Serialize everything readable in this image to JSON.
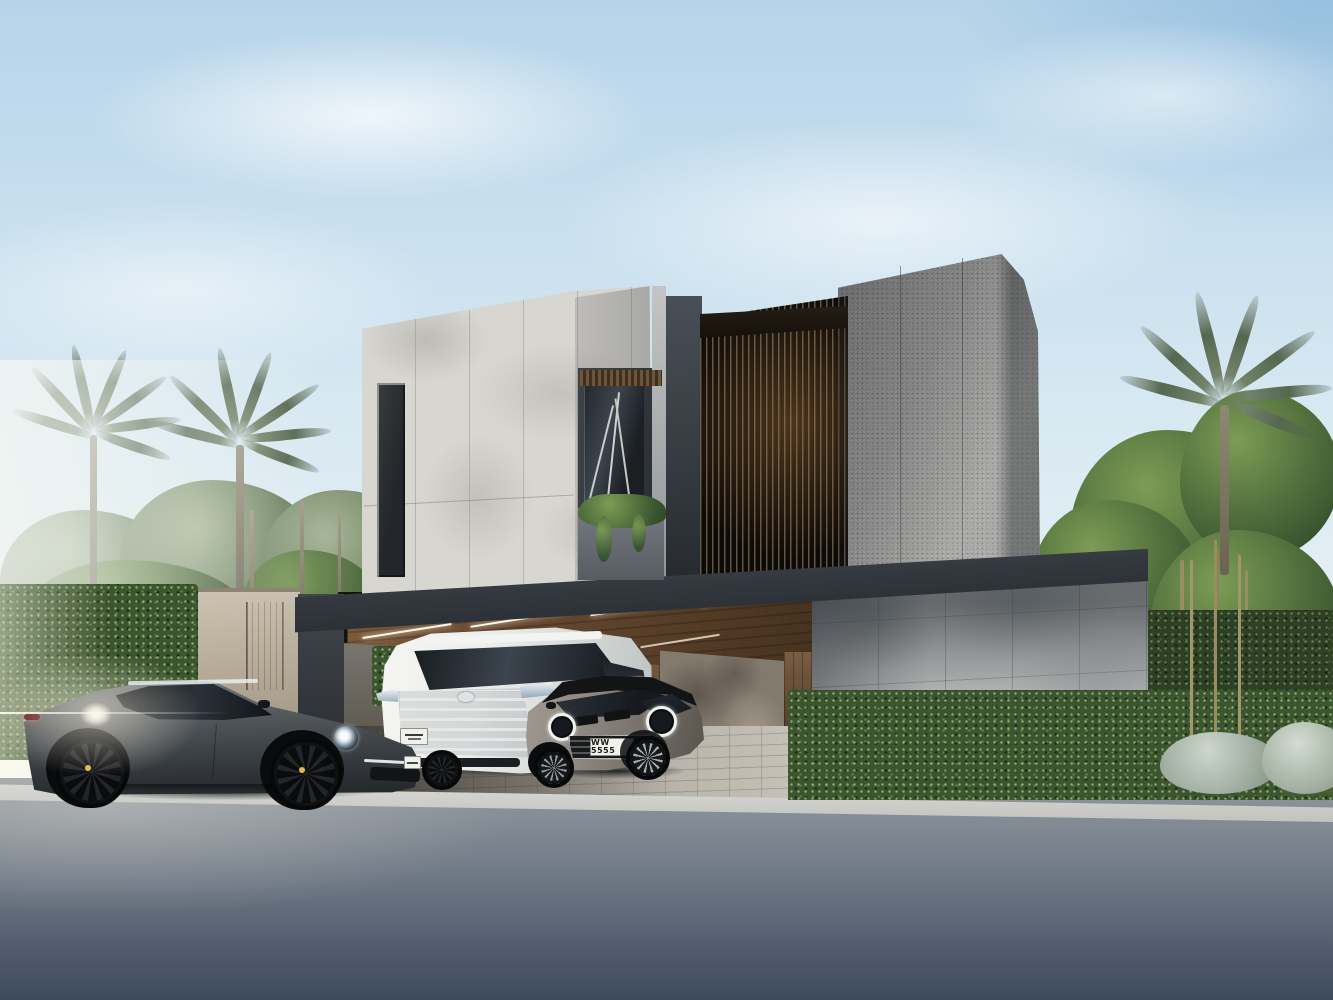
{
  "scene": {
    "type": "exterior architectural rendering",
    "description": "Modern two-storey luxury villa with travertine and granite volumes, vertical slat screen, covered carport with wood ceiling, tall hedges, palm trees, and three cars at dusk sunlight",
    "palette": {
      "sky_top": "#b6d4e9",
      "sky_horizon": "#f3f6f3",
      "travertine": "#d8d6d1",
      "granite": "#9c9c9a",
      "dark_wall": "#3c4147",
      "slat_wood": "#7a6248",
      "ceiling_wood": "#6b4f35",
      "hedge_green": "#3c5531",
      "road_asphalt": "#556172",
      "curb": "#d7d8d3",
      "brake_caliper_red": "#b23a42"
    },
    "environment": {
      "left_hedge": "clipped green hedge wall",
      "right_hedge": "clipped green hedge wall",
      "palms": "date palms",
      "shrubs_silver": "silver foliage shrubs"
    },
    "villa": {
      "volumes": [
        "travertine box",
        "granite box",
        "slat screen bay",
        "carport with wood ceiling",
        "street-side marble wall",
        "entry box with timber door"
      ],
      "lighting": "linear LED strips on carport ceiling"
    },
    "vehicles": {
      "porsche": {
        "label": "grey sports coupe",
        "body_color": "#4e5357"
      },
      "van": {
        "label": "white luxury minivan",
        "body_color": "#eceeec"
      },
      "mini": {
        "label": "grey compact hatchback",
        "body_color": "#8c857e",
        "plate": "WW 5555"
      }
    }
  }
}
